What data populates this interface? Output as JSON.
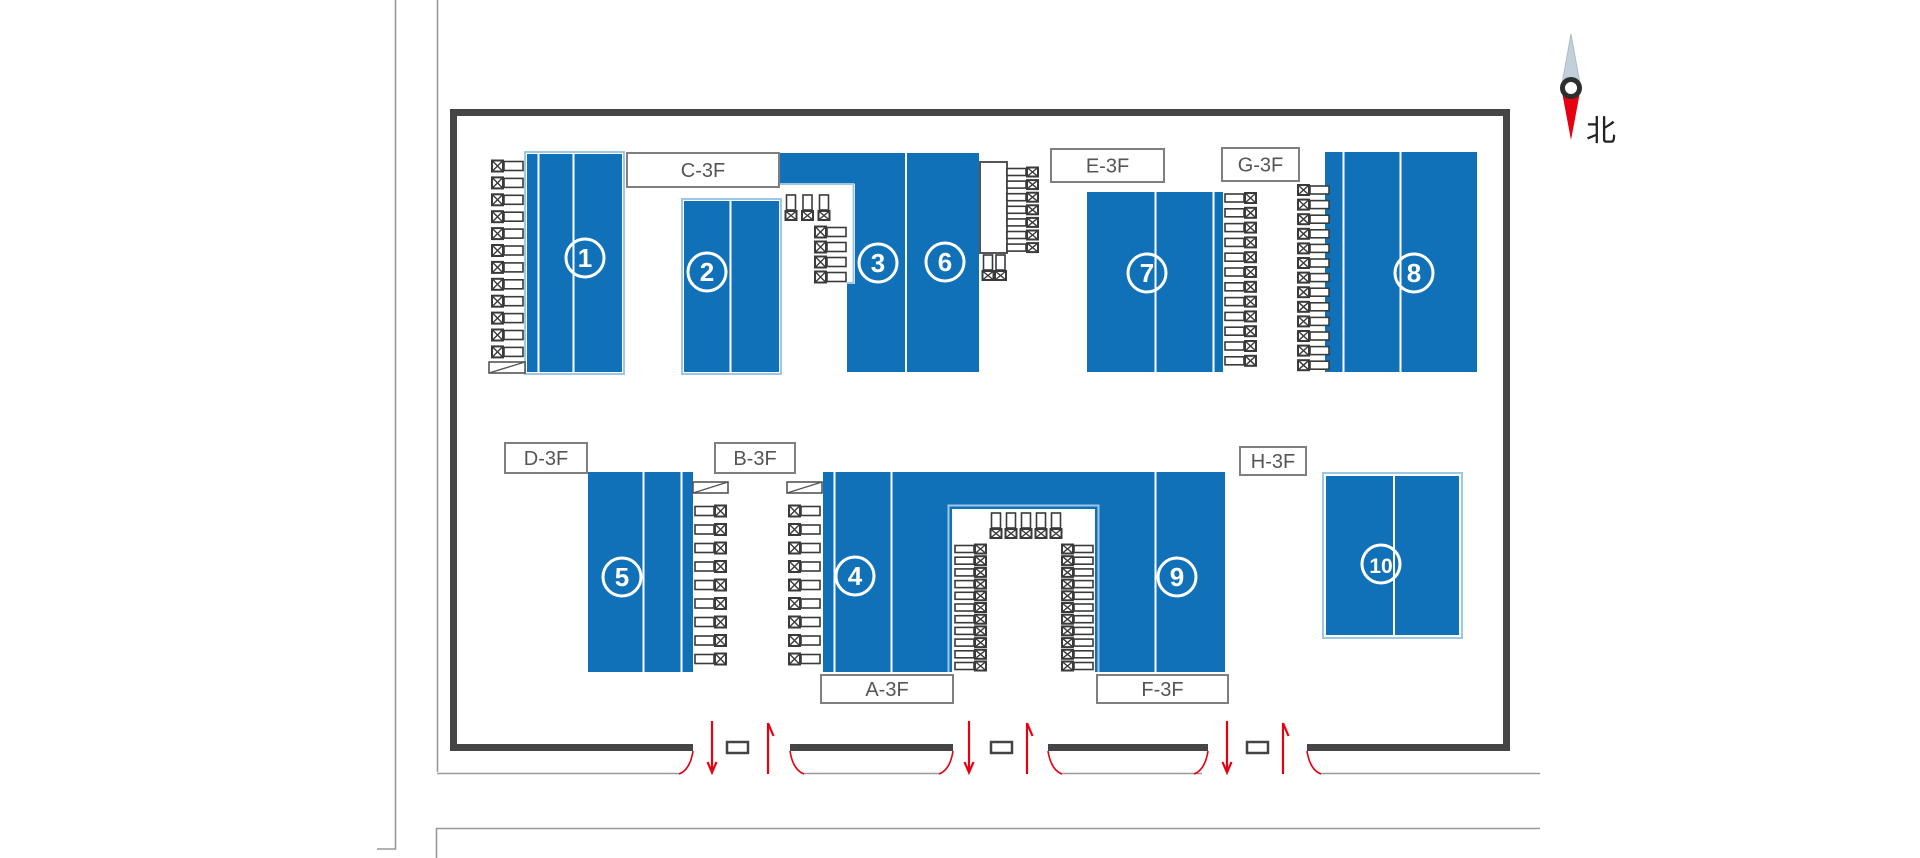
{
  "compass": {
    "label": "北"
  },
  "colors": {
    "building_blue": "#1171b8",
    "building_outline": "#9ec7e6",
    "wall": "#454545",
    "road_line": "#999999",
    "red": "#e60012",
    "label_border": "#7f7f7f",
    "label_text": "#555555",
    "truck": "#3a3a3a",
    "compass_north_tip": "#c2d1d9",
    "compass_south_tip": "#e60012"
  },
  "zone_labels": [
    {
      "text": "C-3F",
      "x": 627,
      "y": 153,
      "w": 152,
      "h": 34
    },
    {
      "text": "E-3F",
      "x": 1051,
      "y": 149,
      "w": 113,
      "h": 33
    },
    {
      "text": "G-3F",
      "x": 1222,
      "y": 148,
      "w": 77,
      "h": 33
    },
    {
      "text": "D-3F",
      "x": 505,
      "y": 443,
      "w": 82,
      "h": 30
    },
    {
      "text": "B-3F",
      "x": 715,
      "y": 443,
      "w": 80,
      "h": 30
    },
    {
      "text": "H-3F",
      "x": 1240,
      "y": 447,
      "w": 66,
      "h": 28
    },
    {
      "text": "A-3F",
      "x": 821,
      "y": 675,
      "w": 132,
      "h": 28
    },
    {
      "text": "F-3F",
      "x": 1097,
      "y": 675,
      "w": 131,
      "h": 28
    }
  ],
  "buildings": [
    {
      "id": "building-1",
      "number": "1",
      "circle": {
        "cx": 585,
        "cy": 258
      },
      "rects": [
        [
          527,
          154,
          95,
          218
        ]
      ],
      "white_lines": [
        [
          538.5,
          154,
          372
        ],
        [
          573.5,
          154,
          372
        ]
      ],
      "outline": [
        525,
        152,
        99,
        222
      ]
    },
    {
      "id": "building-2",
      "number": "2",
      "circle": {
        "cx": 707,
        "cy": 272
      },
      "rects": [
        [
          684,
          201,
          95,
          171
        ]
      ],
      "white_lines": [
        [
          730.5,
          201,
          372
        ]
      ],
      "outline": [
        682,
        199,
        99,
        175
      ]
    },
    {
      "id": "building-3",
      "number": "3",
      "circle": {
        "cx": 878,
        "cy": 263
      },
      "rects": [
        [
          780,
          153,
          199,
          31
        ],
        [
          855,
          183,
          51,
          102
        ],
        [
          847,
          284,
          59,
          88
        ]
      ],
      "white_lines": []
    },
    {
      "id": "building-6",
      "number": "6",
      "circle": {
        "cx": 945,
        "cy": 262
      },
      "rects": [
        [
          906,
          183,
          73,
          189
        ]
      ],
      "white_lines": [
        [
          906,
          153,
          372
        ]
      ]
    },
    {
      "id": "building-7",
      "number": "7",
      "circle": {
        "cx": 1147,
        "cy": 273
      },
      "rects": [
        [
          1087,
          192,
          136,
          180
        ]
      ],
      "white_lines": [
        [
          1155.5,
          192,
          372
        ],
        [
          1213.5,
          192,
          372
        ]
      ]
    },
    {
      "id": "building-8",
      "number": "8",
      "circle": {
        "cx": 1414,
        "cy": 273
      },
      "rects": [
        [
          1325,
          152,
          152,
          220
        ]
      ],
      "white_lines": [
        [
          1343.5,
          152,
          372
        ],
        [
          1400.5,
          152,
          372
        ]
      ]
    },
    {
      "id": "building-5",
      "number": "5",
      "circle": {
        "cx": 622,
        "cy": 577
      },
      "rects": [
        [
          588,
          472,
          105,
          200
        ]
      ],
      "white_lines": [
        [
          643.5,
          472,
          672
        ],
        [
          681.5,
          472,
          672
        ]
      ]
    },
    {
      "id": "building-4",
      "number": "4",
      "circle": {
        "cx": 855,
        "cy": 576
      },
      "rects": [
        [
          823,
          472,
          402,
          37
        ],
        [
          823,
          509,
          129,
          163
        ]
      ],
      "white_lines": [
        [
          834.5,
          472,
          672
        ],
        [
          891.5,
          472,
          672
        ]
      ]
    },
    {
      "id": "building-9",
      "number": "9",
      "circle": {
        "cx": 1177,
        "cy": 577
      },
      "rects": [
        [
          1095,
          509,
          130,
          163
        ]
      ],
      "white_lines": [
        [
          1155.5,
          472,
          672
        ]
      ]
    },
    {
      "id": "building-10",
      "number": "10",
      "circle": {
        "cx": 1381,
        "cy": 564
      },
      "rects": [
        [
          1326,
          476,
          133,
          159
        ]
      ],
      "white_lines": [
        [
          1394,
          476,
          635
        ]
      ],
      "outline": [
        1323,
        473,
        139,
        165
      ]
    }
  ],
  "light_outlines": [
    {
      "name": "building-3-notch-outline",
      "points": [
        [
          780,
          184
        ],
        [
          853.5,
          184
        ],
        [
          853.5,
          283
        ],
        [
          847,
          283
        ]
      ]
    },
    {
      "name": "truck-court-outline",
      "points": [
        [
          948.5,
          672
        ],
        [
          948.5,
          505.5
        ],
        [
          1098.5,
          505.5
        ],
        [
          1098.5,
          672
        ]
      ]
    }
  ],
  "truck_groups": [
    {
      "name": "building-1-west-docks",
      "type": "h",
      "cab": "left",
      "x": 492,
      "y0": 166,
      "dy": 16.9,
      "count": 12,
      "h": 11
    },
    {
      "name": "building-3-court-vertical",
      "type": "v",
      "cab": "down",
      "cx0": 791,
      "dx": 16.5,
      "top": 195,
      "count": 3
    },
    {
      "name": "building-3-court-docks",
      "type": "h",
      "cab": "left",
      "x": 815,
      "y0": 232,
      "dy": 15,
      "count": 4,
      "h": 11
    },
    {
      "name": "building-6-dock-east",
      "type": "h",
      "cab": "right",
      "x": 1007,
      "y0": 172,
      "dy": 12.6,
      "count": 7,
      "h": 9
    },
    {
      "name": "building-6-dock-vertical",
      "type": "v",
      "cab": "down",
      "cx0": 988,
      "dx": 12.5,
      "top": 255,
      "count": 2
    },
    {
      "name": "building-7-east-docks",
      "type": "h",
      "cab": "right",
      "x": 1225,
      "y0": 198,
      "dy": 14.8,
      "count": 12,
      "h": 10
    },
    {
      "name": "building-8-west-docks",
      "type": "h",
      "cab": "left",
      "x": 1298,
      "y0": 190,
      "dy": 14.6,
      "count": 13,
      "h": 10
    },
    {
      "name": "building-5-east-docks",
      "type": "h",
      "cab": "right",
      "x": 695,
      "y0": 511,
      "dy": 18.5,
      "count": 9,
      "h": 11
    },
    {
      "name": "building-4-west-docks",
      "type": "h",
      "cab": "left",
      "x": 789,
      "y0": 511,
      "dy": 18.5,
      "count": 9,
      "h": 11
    },
    {
      "name": "court-north-vertical",
      "type": "v",
      "cab": "down",
      "cx0": 996,
      "dx": 15,
      "top": 513,
      "count": 5
    },
    {
      "name": "court-west-docks",
      "type": "h",
      "cab": "right",
      "x": 955,
      "y0": 549,
      "dy": 11.7,
      "count": 11,
      "h": 9
    },
    {
      "name": "court-east-docks",
      "type": "h",
      "cab": "left",
      "x": 1062,
      "y0": 549,
      "dy": 11.7,
      "count": 11,
      "h": 9
    }
  ],
  "hatch_boxes": [
    [
      489,
      362,
      36,
      11
    ],
    [
      693,
      482,
      35,
      11
    ],
    [
      787,
      482,
      35,
      11
    ]
  ],
  "dock_platform": [
    980,
    162,
    27,
    91
  ],
  "walls": {
    "outline_path": "M453.5,751 L453.5,112.5 L1506.5,112.5 L1506.5,751",
    "bottom_y": 747.5,
    "bottom_segments": [
      [
        450,
        693
      ],
      [
        790,
        953
      ],
      [
        1048,
        1208
      ],
      [
        1307,
        1510
      ]
    ]
  },
  "gates": [
    {
      "opening": [
        693,
        790
      ],
      "box": [
        727,
        742,
        21,
        11
      ],
      "down_arrow_x": 712,
      "up_arrow_x": 768
    },
    {
      "opening": [
        953,
        1048
      ],
      "box": [
        991,
        742,
        21,
        11
      ],
      "down_arrow_x": 969,
      "up_arrow_x": 1027
    },
    {
      "opening": [
        1208,
        1307
      ],
      "box": [
        1247,
        742,
        21,
        11
      ],
      "down_arrow_x": 1227,
      "up_arrow_x": 1283
    }
  ],
  "roads": {
    "paths": [
      "M395.5,0 V849 H377",
      "M437.5,0 V772",
      "M436.5,858 V828.5 H1540"
    ],
    "curb_y": 773.5,
    "curb_segments": [
      [
        437,
        679
      ],
      [
        804,
        939
      ],
      [
        1062,
        1202
      ],
      [
        1321,
        1540
      ]
    ]
  }
}
